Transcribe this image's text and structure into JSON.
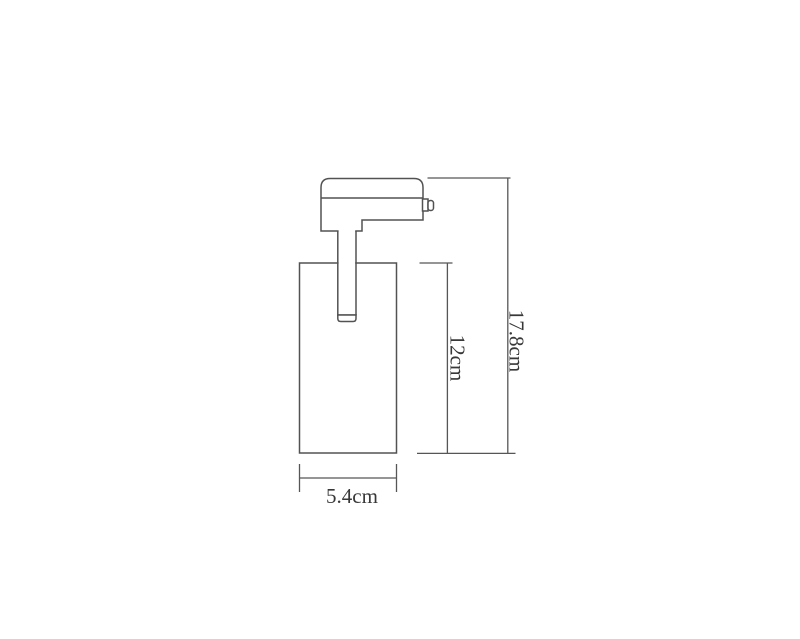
{
  "drawing": {
    "labels": {
      "total_height": "17.8cm",
      "body_height": "12cm",
      "body_width": "5.4cm"
    },
    "values_cm": {
      "total_height": 17.8,
      "body_height": 12,
      "body_width": 5.4
    },
    "colors": {
      "background": "#ffffff",
      "line": "#525252",
      "text": "#383838"
    }
  }
}
